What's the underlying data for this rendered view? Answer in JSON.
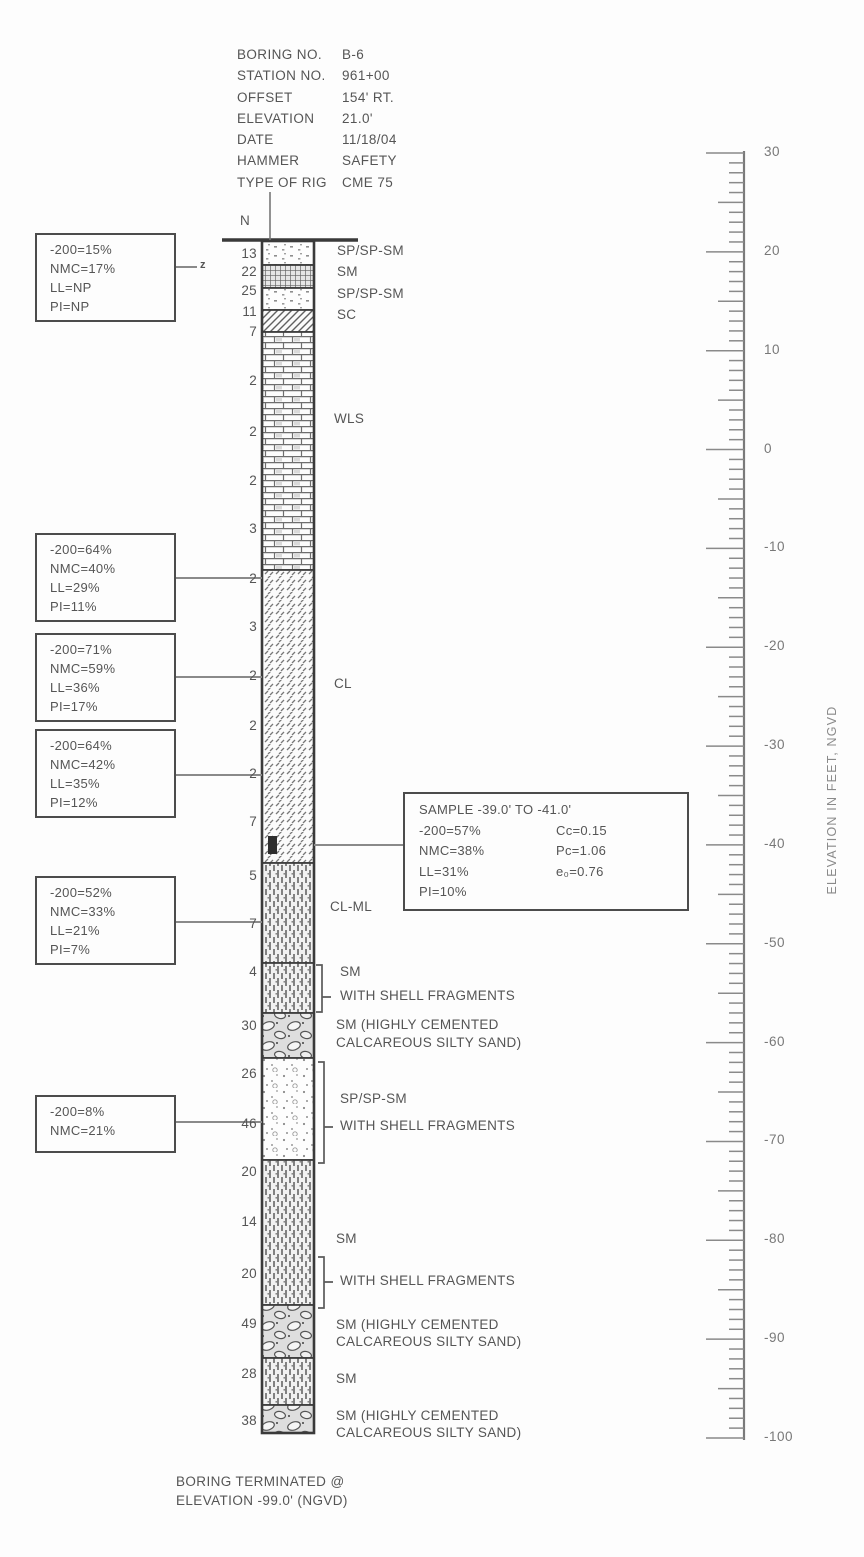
{
  "header": {
    "rows": [
      {
        "label": "BORING NO.",
        "value": "B-6"
      },
      {
        "label": "STATION NO.",
        "value": "961+00"
      },
      {
        "label": "OFFSET",
        "value": "154' RT."
      },
      {
        "label": "ELEVATION",
        "value": "21.0'"
      },
      {
        "label": "DATE",
        "value": "11/18/04"
      },
      {
        "label": "HAMMER",
        "value": "SAFETY"
      },
      {
        "label": "TYPE OF RIG",
        "value": "CME 75"
      }
    ]
  },
  "n_label": "N",
  "column": {
    "x": 262,
    "w": 52,
    "top": 241,
    "bottom": 1433,
    "n_values": [
      {
        "v": "13",
        "y": 255
      },
      {
        "v": "22",
        "y": 273
      },
      {
        "v": "25",
        "y": 292
      },
      {
        "v": "11",
        "y": 313
      },
      {
        "v": "7",
        "y": 333
      },
      {
        "v": "2",
        "y": 382
      },
      {
        "v": "2",
        "y": 433
      },
      {
        "v": "2",
        "y": 482
      },
      {
        "v": "3",
        "y": 530
      },
      {
        "v": "2",
        "y": 580
      },
      {
        "v": "3",
        "y": 628
      },
      {
        "v": "2",
        "y": 677
      },
      {
        "v": "2",
        "y": 727
      },
      {
        "v": "2",
        "y": 775
      },
      {
        "v": "7",
        "y": 823
      },
      {
        "v": "5",
        "y": 877
      },
      {
        "v": "7",
        "y": 925
      },
      {
        "v": "4",
        "y": 973
      },
      {
        "v": "30",
        "y": 1027
      },
      {
        "v": "26",
        "y": 1075
      },
      {
        "v": "46",
        "y": 1125
      },
      {
        "v": "20",
        "y": 1173
      },
      {
        "v": "14",
        "y": 1223
      },
      {
        "v": "20",
        "y": 1275
      },
      {
        "v": "49",
        "y": 1325
      },
      {
        "v": "28",
        "y": 1375
      },
      {
        "v": "38",
        "y": 1422
      }
    ],
    "layers": [
      {
        "soil": "SP/SP-SM",
        "pattern": "dots",
        "y1": 241,
        "y2": 265
      },
      {
        "soil": "SM",
        "pattern": "grid",
        "y1": 265,
        "y2": 288
      },
      {
        "soil": "SP/SP-SM",
        "pattern": "dots",
        "y1": 288,
        "y2": 310
      },
      {
        "soil": "SC",
        "pattern": "diag",
        "y1": 310,
        "y2": 332
      },
      {
        "soil": "WLS",
        "pattern": "brick",
        "y1": 332,
        "y2": 570
      },
      {
        "soil": "CL",
        "pattern": "clhatch",
        "y1": 570,
        "y2": 863
      },
      {
        "soil": "CL-ML",
        "pattern": "vdash",
        "y1": 863,
        "y2": 963
      },
      {
        "soil": "SM WITH SHELL FRAGMENTS",
        "pattern": "vdash",
        "y1": 963,
        "y2": 1013
      },
      {
        "soil": "SM (HIGHLY CEMENTED CALCAREOUS SILTY SAND)",
        "pattern": "cobble",
        "y1": 1013,
        "y2": 1058
      },
      {
        "soil": "SP/SP-SM WITH SHELL FRAGMENTS",
        "pattern": "speckle",
        "y1": 1058,
        "y2": 1160
      },
      {
        "soil": "SM",
        "pattern": "vdash",
        "y1": 1160,
        "y2": 1305
      },
      {
        "soil": "SM (HIGHLY CEMENTED CALCAREOUS SILTY SAND)",
        "pattern": "cobble",
        "y1": 1305,
        "y2": 1358
      },
      {
        "soil": "SM",
        "pattern": "vdash",
        "y1": 1358,
        "y2": 1405
      },
      {
        "soil": "SM (HIGHLY CEMENTED CALCAREOUS SILTY SAND)",
        "pattern": "cobble",
        "y1": 1405,
        "y2": 1433
      }
    ],
    "sample_mark": {
      "x": 268,
      "y1": 836,
      "y2": 854,
      "w": 9
    }
  },
  "ground_line": {
    "x1": 222,
    "x2": 358,
    "y": 240
  },
  "drop_line": {
    "x": 270,
    "y1": 192,
    "y2": 240
  },
  "layer_labels": [
    {
      "text": "SP/SP-SM",
      "x": 337,
      "y": 252
    },
    {
      "text": "SM",
      "x": 337,
      "y": 273
    },
    {
      "text": "SP/SP-SM",
      "x": 337,
      "y": 295
    },
    {
      "text": "SC",
      "x": 337,
      "y": 316
    },
    {
      "text": "WLS",
      "x": 334,
      "y": 420
    },
    {
      "text": "CL",
      "x": 334,
      "y": 685
    },
    {
      "text": "CL-ML",
      "x": 330,
      "y": 908
    },
    {
      "text": "SM",
      "x": 340,
      "y": 973
    },
    {
      "text": "WITH SHELL FRAGMENTS",
      "x": 340,
      "y": 997
    },
    {
      "text": "SM (HIGHLY CEMENTED",
      "x": 336,
      "y": 1026
    },
    {
      "text": "CALCAREOUS SILTY SAND)",
      "x": 336,
      "y": 1044
    },
    {
      "text": "SP/SP-SM",
      "x": 340,
      "y": 1100
    },
    {
      "text": "WITH SHELL FRAGMENTS",
      "x": 340,
      "y": 1127
    },
    {
      "text": "SM",
      "x": 336,
      "y": 1240
    },
    {
      "text": "WITH SHELL FRAGMENTS",
      "x": 340,
      "y": 1282
    },
    {
      "text": "SM (HIGHLY CEMENTED",
      "x": 336,
      "y": 1326
    },
    {
      "text": "CALCAREOUS SILTY SAND)",
      "x": 336,
      "y": 1343
    },
    {
      "text": "SM",
      "x": 336,
      "y": 1380
    },
    {
      "text": "SM (HIGHLY CEMENTED",
      "x": 336,
      "y": 1417
    },
    {
      "text": "CALCAREOUS SILTY SAND)",
      "x": 336,
      "y": 1434
    }
  ],
  "brackets": [
    {
      "x": 322,
      "y1": 965,
      "y2": 1012,
      "mid": 997
    },
    {
      "x": 324,
      "y1": 1062,
      "y2": 1163,
      "mid": 1127
    },
    {
      "x": 324,
      "y1": 1257,
      "y2": 1308,
      "mid": 1282
    }
  ],
  "callouts": [
    {
      "x": 35,
      "y": 233,
      "w": 141,
      "h": 80,
      "lines": [
        "-200=15%",
        "NMC=17%",
        "LL=NP",
        "PI=NP"
      ],
      "leader": {
        "y": 267,
        "x1": 176,
        "x2": 197
      },
      "end_symbol": "z"
    },
    {
      "x": 35,
      "y": 533,
      "w": 141,
      "h": 82,
      "lines": [
        "-200=64%",
        "NMC=40%",
        "LL=29%",
        "PI=11%"
      ],
      "leader": {
        "y": 578,
        "x1": 176,
        "x2": 262
      }
    },
    {
      "x": 35,
      "y": 633,
      "w": 141,
      "h": 86,
      "lines": [
        "-200=71%",
        "NMC=59%",
        "LL=36%",
        "PI=17%"
      ],
      "leader": {
        "y": 677,
        "x1": 176,
        "x2": 262
      }
    },
    {
      "x": 35,
      "y": 729,
      "w": 141,
      "h": 86,
      "lines": [
        "-200=64%",
        "NMC=42%",
        "LL=35%",
        "PI=12%"
      ],
      "leader": {
        "y": 775,
        "x1": 176,
        "x2": 262
      }
    },
    {
      "x": 35,
      "y": 876,
      "w": 141,
      "h": 85,
      "lines": [
        "-200=52%",
        "NMC=33%",
        "LL=21%",
        "PI=7%"
      ],
      "leader": {
        "y": 922,
        "x1": 176,
        "x2": 262
      }
    },
    {
      "x": 35,
      "y": 1095,
      "w": 141,
      "h": 58,
      "lines": [
        "-200=8%",
        "NMC=21%"
      ],
      "leader": {
        "y": 1122,
        "x1": 176,
        "x2": 262
      }
    }
  ],
  "sample_box": {
    "x": 403,
    "y": 792,
    "w": 286,
    "h": 110,
    "title": "SAMPLE -39.0' TO -41.0'",
    "left": [
      "-200=57%",
      "NMC=38%",
      "LL=31%",
      "PI=10%"
    ],
    "right": [
      "Cc=0.15",
      "Pc=1.06",
      "e₀=0.76"
    ],
    "leader": {
      "y": 845,
      "x1": 314,
      "x2": 403
    }
  },
  "scale": {
    "x_line": 744,
    "y_top": 153,
    "px_per_ft": 9.8846,
    "elev_top": 30,
    "elev_bottom": -100,
    "tick_labels": [
      30,
      20,
      10,
      0,
      -10,
      -20,
      -30,
      -40,
      -50,
      -60,
      -70,
      -80,
      -90,
      -100
    ],
    "axis_label": "ELEVATION IN FEET, NGVD"
  },
  "footer": {
    "line1": "BORING TERMINATED @",
    "line2": "ELEVATION -99.0' (NGVD)"
  },
  "colors": {
    "ink": "#555555",
    "line": "#8a8a8a",
    "border": "#4c4c4c",
    "dark": "#3a3a3a"
  }
}
